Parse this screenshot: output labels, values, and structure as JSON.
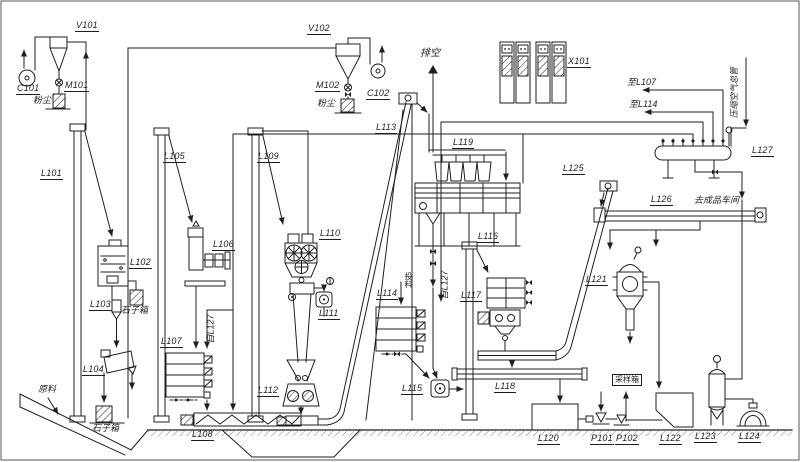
{
  "page": {
    "background": "#ffffff",
    "ink": "#1f1f1f"
  },
  "labels": {
    "v101": "V101",
    "c101": "C101",
    "m101": "M101",
    "v102": "V102",
    "m102": "M102",
    "c102": "C102",
    "x101": "X101",
    "l101": "L101",
    "l102": "L102",
    "l103": "L103",
    "l104": "L104",
    "l105": "L105",
    "l106": "L106",
    "l107": "L107",
    "l108": "L108",
    "l109": "L109",
    "l110": "L110",
    "l111": "L111",
    "l112": "L112",
    "l113": "L113",
    "l114": "L114",
    "l115": "L115",
    "l116": "L116",
    "l117": "L117",
    "l118": "L118",
    "l119": "L119",
    "l120": "L120",
    "l121": "L121",
    "l122": "L122",
    "l123": "L123",
    "l124": "L124",
    "l125": "L125",
    "l126": "L126",
    "l127": "L127",
    "p101": "P101",
    "p102": "P102"
  },
  "annotations": {
    "vent": "排空",
    "to_l107": "至L107",
    "to_l114": "至L114",
    "from_l127_left": "自L127",
    "from_l127_right": "自L127",
    "raw_material": "原料",
    "dust_left": "粉尘",
    "dust_mid": "粉尘",
    "stone_box_upper": "石子箱",
    "stone_box_lower": "石子箱",
    "manual_feed": "投料",
    "to_workshop": "去成品车间",
    "compressed_air": "压缩空气总管",
    "sampling_box": "采样箱"
  }
}
